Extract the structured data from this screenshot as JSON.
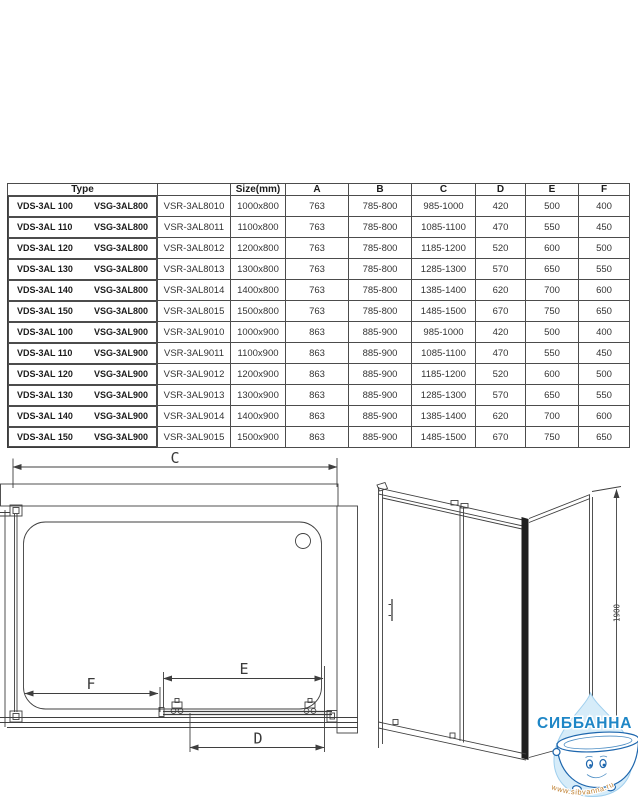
{
  "table": {
    "headers": {
      "type": "Type",
      "model": "",
      "size": "Size(mm)",
      "a": "A",
      "b": "B",
      "c": "C",
      "d": "D",
      "e": "E",
      "f": "F"
    },
    "rows": [
      {
        "vds": "VDS-3AL 100",
        "vsg": "VSG-3AL800",
        "vsr": "VSR-3AL8010",
        "size": "1000x800",
        "a": "763",
        "b": "785-800",
        "c": "985-1000",
        "d": "420",
        "e": "500",
        "f": "400"
      },
      {
        "vds": "VDS-3AL 110",
        "vsg": "VSG-3AL800",
        "vsr": "VSR-3AL8011",
        "size": "1100x800",
        "a": "763",
        "b": "785-800",
        "c": "1085-1100",
        "d": "470",
        "e": "550",
        "f": "450"
      },
      {
        "vds": "VDS-3AL 120",
        "vsg": "VSG-3AL800",
        "vsr": "VSR-3AL8012",
        "size": "1200x800",
        "a": "763",
        "b": "785-800",
        "c": "1185-1200",
        "d": "520",
        "e": "600",
        "f": "500"
      },
      {
        "vds": "VDS-3AL 130",
        "vsg": "VSG-3AL800",
        "vsr": "VSR-3AL8013",
        "size": "1300x800",
        "a": "763",
        "b": "785-800",
        "c": "1285-1300",
        "d": "570",
        "e": "650",
        "f": "550"
      },
      {
        "vds": "VDS-3AL 140",
        "vsg": "VSG-3AL800",
        "vsr": "VSR-3AL8014",
        "size": "1400x800",
        "a": "763",
        "b": "785-800",
        "c": "1385-1400",
        "d": "620",
        "e": "700",
        "f": "600"
      },
      {
        "vds": "VDS-3AL 150",
        "vsg": "VSG-3AL800",
        "vsr": "VSR-3AL8015",
        "size": "1500x800",
        "a": "763",
        "b": "785-800",
        "c": "1485-1500",
        "d": "670",
        "e": "750",
        "f": "650"
      },
      {
        "vds": "VDS-3AL 100",
        "vsg": "VSG-3AL900",
        "vsr": "VSR-3AL9010",
        "size": "1000x900",
        "a": "863",
        "b": "885-900",
        "c": "985-1000",
        "d": "420",
        "e": "500",
        "f": "400"
      },
      {
        "vds": "VDS-3AL 110",
        "vsg": "VSG-3AL900",
        "vsr": "VSR-3AL9011",
        "size": "1100x900",
        "a": "863",
        "b": "885-900",
        "c": "1085-1100",
        "d": "470",
        "e": "550",
        "f": "450"
      },
      {
        "vds": "VDS-3AL 120",
        "vsg": "VSG-3AL900",
        "vsr": "VSR-3AL9012",
        "size": "1200x900",
        "a": "863",
        "b": "885-900",
        "c": "1185-1200",
        "d": "520",
        "e": "600",
        "f": "500"
      },
      {
        "vds": "VDS-3AL 130",
        "vsg": "VSG-3AL900",
        "vsr": "VSR-3AL9013",
        "size": "1300x900",
        "a": "863",
        "b": "885-900",
        "c": "1285-1300",
        "d": "570",
        "e": "650",
        "f": "550"
      },
      {
        "vds": "VDS-3AL 140",
        "vsg": "VSG-3AL900",
        "vsr": "VSR-3AL9014",
        "size": "1400x900",
        "a": "863",
        "b": "885-900",
        "c": "1385-1400",
        "d": "620",
        "e": "700",
        "f": "600"
      },
      {
        "vds": "VDS-3AL 150",
        "vsg": "VSG-3AL900",
        "vsr": "VSR-3AL9015",
        "size": "1500x900",
        "a": "863",
        "b": "885-900",
        "c": "1485-1500",
        "d": "670",
        "e": "750",
        "f": "650"
      }
    ]
  },
  "drawings": {
    "top_view": {
      "dim_c": "C",
      "dim_f": "F",
      "dim_e": "E",
      "dim_d": "D"
    },
    "front_view": {
      "dim_height": "1900"
    }
  },
  "watermark": {
    "brand": "СИББАННА",
    "url": "www.sibvanna.ru",
    "brand_color": "#1e86c6",
    "url_color": "#bf7f2f",
    "drop_color": "#d6ecf9",
    "drop_stroke": "#9fcfee"
  }
}
